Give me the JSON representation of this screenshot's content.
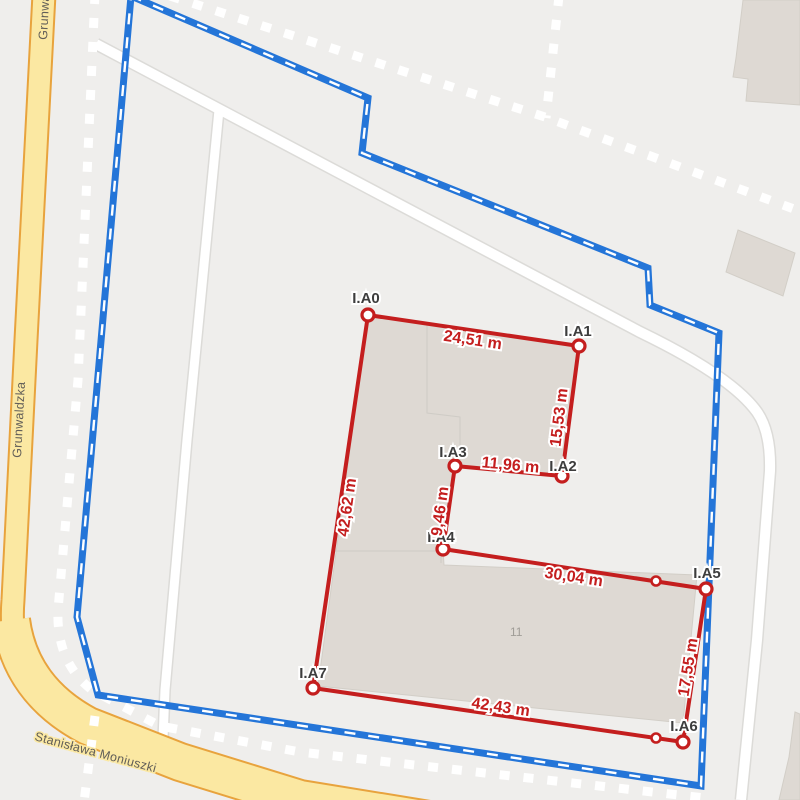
{
  "map": {
    "streets": {
      "grunwaldzka": "Grunwaldzka",
      "moniuszki": "Stanisława Moniuszki"
    },
    "building_number": "11",
    "colors": {
      "background": "#efeeec",
      "parcel_boundary_blue": "#2475d8",
      "measurement_red": "#c41e1e",
      "road_fill_yellow": "#fbe8a2",
      "road_casing_orange": "#e8a33d",
      "building_fill": "#ded9d3"
    }
  },
  "measurement": {
    "vertices": [
      {
        "id": "I.A0"
      },
      {
        "id": "I.A1"
      },
      {
        "id": "I.A2"
      },
      {
        "id": "I.A3"
      },
      {
        "id": "I.A4"
      },
      {
        "id": "I.A5"
      },
      {
        "id": "I.A6"
      },
      {
        "id": "I.A7"
      }
    ],
    "edges": [
      {
        "from": "I.A0",
        "to": "I.A1",
        "label": "24,51 m"
      },
      {
        "from": "I.A1",
        "to": "I.A2",
        "label": "15,53 m"
      },
      {
        "from": "I.A3",
        "to": "I.A2",
        "label": "11,96 m"
      },
      {
        "from": "I.A3",
        "to": "I.A4",
        "label": "9,46 m"
      },
      {
        "from": "I.A4",
        "to": "I.A5",
        "label": "30,04 m"
      },
      {
        "from": "I.A5",
        "to": "I.A6",
        "label": "17,55 m"
      },
      {
        "from": "I.A7",
        "to": "I.A6",
        "label": "42,43 m"
      },
      {
        "from": "I.A0",
        "to": "I.A7",
        "label": "42,62 m"
      }
    ]
  }
}
